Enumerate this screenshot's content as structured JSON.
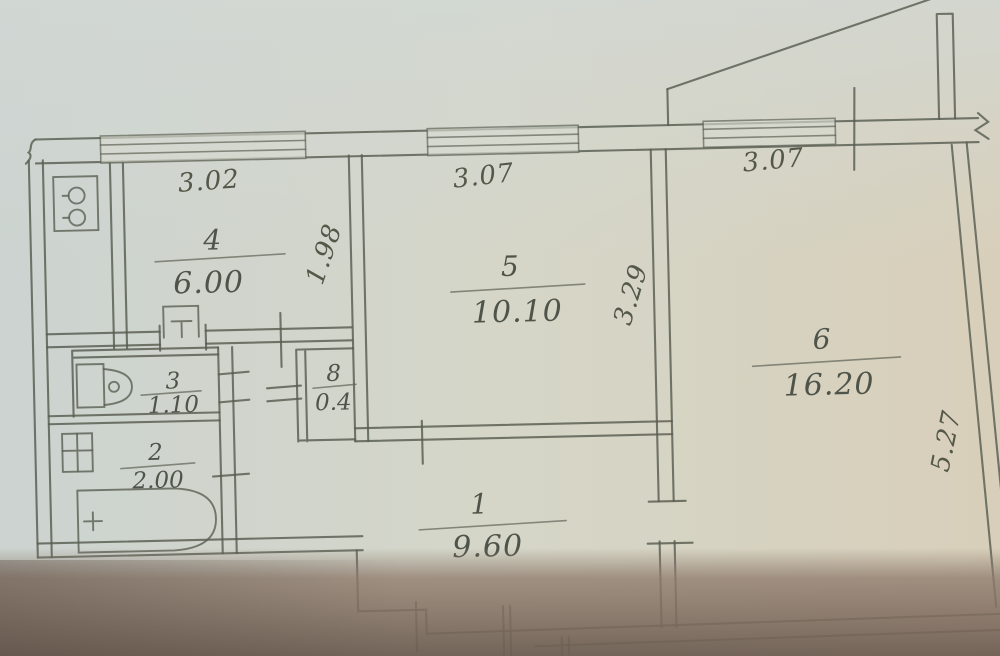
{
  "plan": {
    "rooms": [
      {
        "id": "hall",
        "number": "1",
        "area": "9.60"
      },
      {
        "id": "bathroom",
        "number": "2",
        "area": "2.00"
      },
      {
        "id": "toilet",
        "number": "3",
        "area": "1.10"
      },
      {
        "id": "kitchen",
        "number": "4",
        "area": "6.00"
      },
      {
        "id": "room5",
        "number": "5",
        "area": "10.10"
      },
      {
        "id": "room6",
        "number": "6",
        "area": "16.20"
      },
      {
        "id": "closet",
        "number": "8",
        "area": "0.4"
      }
    ],
    "dimensions": [
      {
        "id": "kitchen-window-width",
        "value": "3.02"
      },
      {
        "id": "room5-window-width",
        "value": "3.07"
      },
      {
        "id": "room6-window-width",
        "value": "3.07"
      },
      {
        "id": "kitchen-wall-depth",
        "value": "1.98"
      },
      {
        "id": "room5-wall-depth",
        "value": "3.29"
      },
      {
        "id": "room6-wall-depth",
        "value": "5.27"
      }
    ],
    "colors": {
      "paper_cool": "#cdd3cf",
      "paper_warm": "#d8cfba",
      "shadow_brown": "#8d7a6c",
      "ink": "#585d51"
    }
  }
}
